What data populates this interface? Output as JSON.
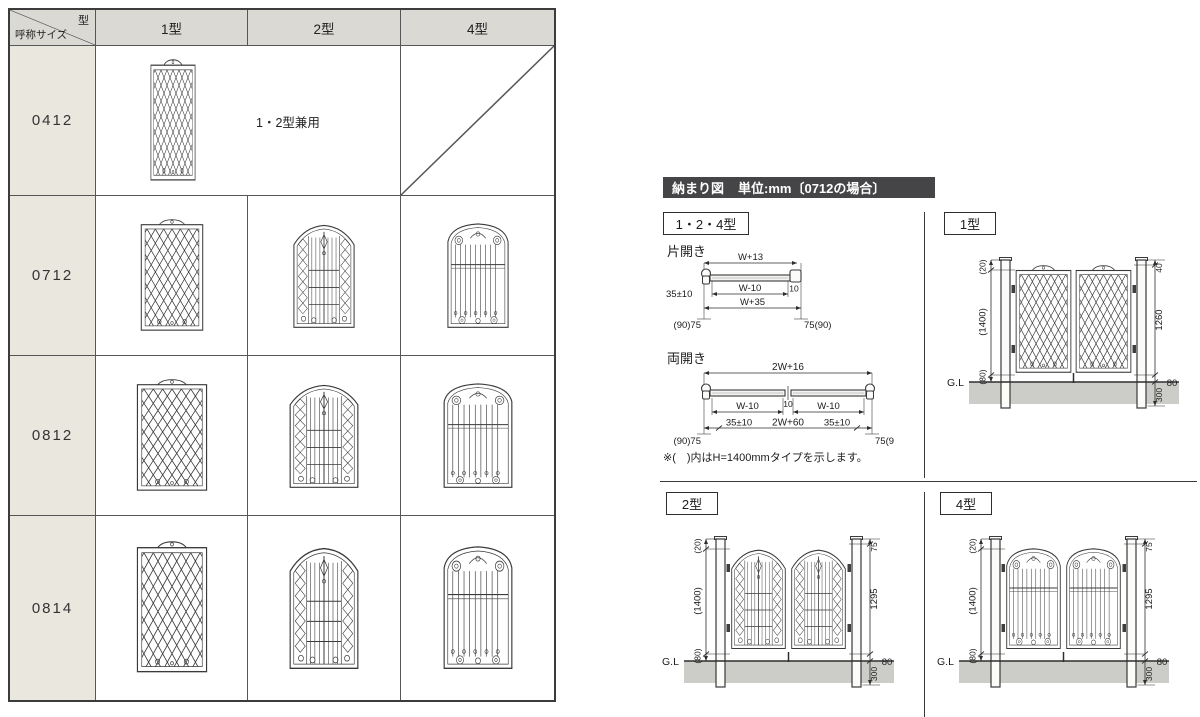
{
  "table": {
    "corner_top": "型",
    "corner_bottom": "呼称サイズ",
    "columns": [
      "1型",
      "2型",
      "4型"
    ],
    "rows": [
      {
        "size": "0412",
        "note": "1・2型兼用"
      },
      {
        "size": "0712"
      },
      {
        "size": "0812"
      },
      {
        "size": "0814"
      }
    ]
  },
  "details": {
    "title": "納まり図",
    "unit": "単位:mm〔0712の場合〕",
    "group_label": "1・2・4型",
    "single": {
      "label": "片開き",
      "dims": {
        "top": "W+13",
        "inner": "W-10",
        "gap": "10",
        "outer": "W+35",
        "setback": "35±10",
        "left_post": "(90)75",
        "right_post": "75(90)"
      }
    },
    "double": {
      "label": "両開き",
      "dims": {
        "top": "2W+16",
        "left": "W-10",
        "gap": "10",
        "right": "W-10",
        "bottom_left": "35±10",
        "bottom_center": "2W+60",
        "bottom_right": "35±10",
        "left_post": "(90)75",
        "right_post": "75(90)"
      }
    },
    "note": "※(　)内はH=1400mmタイプを示します。",
    "gl_label": "G.L",
    "elevations": [
      {
        "label": "1型",
        "type": 1,
        "left_dims": [
          "(20)",
          "(1400)",
          "(80)"
        ],
        "right_dims": [
          "40",
          "1260",
          "80",
          "300"
        ]
      },
      {
        "label": "2型",
        "type": 2,
        "left_dims": [
          "(20)",
          "(1400)",
          "(80)"
        ],
        "right_dims": [
          "75",
          "1295",
          "80",
          "300"
        ]
      },
      {
        "label": "4型",
        "type": 4,
        "left_dims": [
          "(20)",
          "(1400)",
          "(80)"
        ],
        "right_dims": [
          "75",
          "1295",
          "80",
          "300"
        ]
      }
    ]
  },
  "colors": {
    "header_bg": "#dad9d4",
    "row_label_bg": "#eae7df",
    "title_bar_bg": "#454547",
    "ground_fill": "#ccccc9",
    "line": "#2e2e2e"
  }
}
